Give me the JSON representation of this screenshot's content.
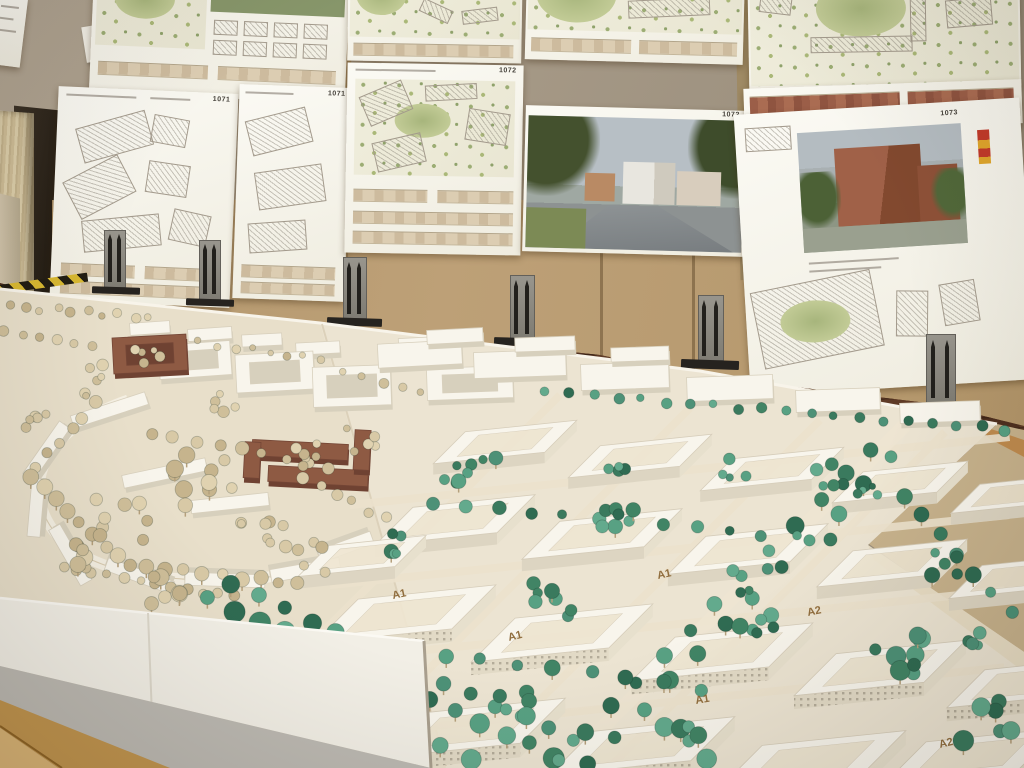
{
  "meta": {
    "scene_description": "Photograph of an architecture exhibition room: a large white urban-planning scale model with teal and beige foam trees stands on tables in the foreground; behind it, competition poster boards with site plans, elevations and renderings are pinned to tan cardboard panels standing on a dark parquet floor.",
    "left_model_area": "cream base, curved terrace street, beige trees, two red-brick building groups",
    "right_model_area": "white perimeter housing blocks with courtyards, teal tree rows and clusters, wooden block labels"
  },
  "posters": {
    "numbers": [
      {
        "value": "1071"
      },
      {
        "value": "1071"
      },
      {
        "value": "1072"
      },
      {
        "value": "1072"
      },
      {
        "value": "1073"
      }
    ]
  },
  "model": {
    "labels": [
      {
        "text": "A1"
      },
      {
        "text": "A1"
      },
      {
        "text": "A1"
      },
      {
        "text": "A2"
      },
      {
        "text": "A1"
      },
      {
        "text": "A2"
      }
    ]
  },
  "palette": {
    "wall": "#a89b88",
    "cardboard": "#b2966b",
    "floor_wood": "#4f301f",
    "poster_white": "#fbfaf4",
    "model_cream": "#eae2d0",
    "building_white": "#f7f4eb",
    "brick": "#8e5a43",
    "tree_teal": "#4d9177",
    "tree_beige": "#d8c9a6",
    "table_grey": "#bdbab3",
    "table_plywood": "#c7b28c",
    "wood_frame": "#c1954f",
    "hazard_yellow": "#d8b832"
  }
}
